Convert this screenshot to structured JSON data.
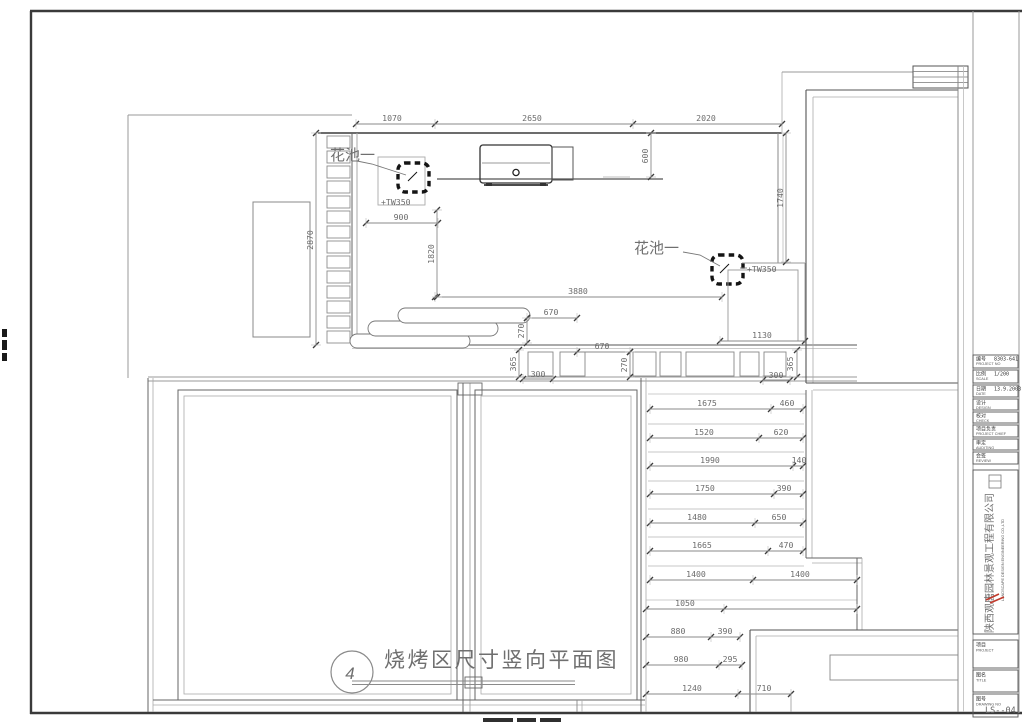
{
  "sheet": {
    "drawing_title": "烧烤区尺寸竖向平面图",
    "view_number": "4",
    "labels": {
      "flower_bed_1": "花池一",
      "flower_bed_1_level": "+TW350",
      "flower_bed_2": "花池一",
      "flower_bed_2_level": "+TW350"
    },
    "dimensions": [
      {
        "t": "1070",
        "x": 392,
        "y": 121
      },
      {
        "t": "2650",
        "x": 532,
        "y": 121
      },
      {
        "t": "2020",
        "x": 706,
        "y": 121
      },
      {
        "t": "600",
        "x": 648,
        "y": 156,
        "r": -90
      },
      {
        "t": "1740",
        "x": 783,
        "y": 198,
        "r": -90
      },
      {
        "t": "2870",
        "x": 313,
        "y": 240,
        "r": -90
      },
      {
        "t": "900",
        "x": 401,
        "y": 220
      },
      {
        "t": "1820",
        "x": 434,
        "y": 254,
        "r": -90
      },
      {
        "t": "3880",
        "x": 578,
        "y": 294
      },
      {
        "t": "670",
        "x": 551,
        "y": 315
      },
      {
        "t": "270",
        "x": 524,
        "y": 331,
        "r": -90
      },
      {
        "t": "1130",
        "x": 762,
        "y": 338
      },
      {
        "t": "365",
        "x": 516,
        "y": 364,
        "r": -90
      },
      {
        "t": "300",
        "x": 538,
        "y": 377
      },
      {
        "t": "670",
        "x": 602,
        "y": 349
      },
      {
        "t": "270",
        "x": 627,
        "y": 365,
        "r": -90
      },
      {
        "t": "365",
        "x": 793,
        "y": 364,
        "r": -90
      },
      {
        "t": "300",
        "x": 776,
        "y": 378
      },
      {
        "t": "1675",
        "x": 707,
        "y": 406
      },
      {
        "t": "460",
        "x": 787,
        "y": 406
      },
      {
        "t": "1520",
        "x": 704,
        "y": 435
      },
      {
        "t": "620",
        "x": 781,
        "y": 435
      },
      {
        "t": "1990",
        "x": 710,
        "y": 463
      },
      {
        "t": "140",
        "x": 799,
        "y": 463
      },
      {
        "t": "1750",
        "x": 705,
        "y": 491
      },
      {
        "t": "390",
        "x": 784,
        "y": 491
      },
      {
        "t": "1480",
        "x": 697,
        "y": 520
      },
      {
        "t": "650",
        "x": 779,
        "y": 520
      },
      {
        "t": "1665",
        "x": 702,
        "y": 548
      },
      {
        "t": "470",
        "x": 786,
        "y": 548
      },
      {
        "t": "1400",
        "x": 696,
        "y": 577
      },
      {
        "t": "1400",
        "x": 800,
        "y": 577
      },
      {
        "t": "1050",
        "x": 685,
        "y": 606
      },
      {
        "t": "880",
        "x": 678,
        "y": 634
      },
      {
        "t": "390",
        "x": 725,
        "y": 634
      },
      {
        "t": "980",
        "x": 681,
        "y": 662
      },
      {
        "t": "295",
        "x": 730,
        "y": 662
      },
      {
        "t": "1240",
        "x": 692,
        "y": 691
      },
      {
        "t": "710",
        "x": 764,
        "y": 691
      }
    ],
    "dim_lines": [
      {
        "o": "h",
        "y": 124,
        "x1": 356,
        "x2": 782,
        "ticks": [
          356,
          435,
          633,
          782
        ]
      },
      {
        "o": "h",
        "y": 223,
        "x1": 366,
        "x2": 438,
        "ticks": [
          366,
          438
        ]
      },
      {
        "o": "h",
        "y": 297,
        "x1": 435,
        "x2": 722,
        "ticks": [
          435,
          722
        ]
      },
      {
        "o": "h",
        "y": 318,
        "x1": 527,
        "x2": 577,
        "ticks": [
          527,
          577
        ]
      },
      {
        "o": "h",
        "y": 341,
        "x1": 720,
        "x2": 805,
        "ticks": [
          720,
          805
        ]
      },
      {
        "o": "h",
        "y": 352,
        "x1": 577,
        "x2": 630,
        "ticks": [
          577,
          630
        ]
      },
      {
        "o": "h",
        "y": 379,
        "x1": 523,
        "x2": 553,
        "ticks": [
          523,
          553
        ]
      },
      {
        "o": "h",
        "y": 380,
        "x1": 763,
        "x2": 790,
        "ticks": [
          763,
          790
        ]
      },
      {
        "o": "h",
        "y": 409,
        "x1": 650,
        "x2": 803,
        "ticks": [
          650,
          771,
          803
        ]
      },
      {
        "o": "h",
        "y": 438,
        "x1": 650,
        "x2": 803,
        "ticks": [
          650,
          759,
          803
        ]
      },
      {
        "o": "h",
        "y": 466,
        "x1": 650,
        "x2": 803,
        "ticks": [
          650,
          793,
          803
        ]
      },
      {
        "o": "h",
        "y": 494,
        "x1": 650,
        "x2": 803,
        "ticks": [
          650,
          774,
          803
        ]
      },
      {
        "o": "h",
        "y": 523,
        "x1": 650,
        "x2": 803,
        "ticks": [
          650,
          755,
          803
        ]
      },
      {
        "o": "h",
        "y": 551,
        "x1": 650,
        "x2": 803,
        "ticks": [
          650,
          768,
          803
        ]
      },
      {
        "o": "h",
        "y": 580,
        "x1": 650,
        "x2": 857,
        "ticks": [
          650,
          753,
          857
        ]
      },
      {
        "o": "h",
        "y": 609,
        "x1": 646,
        "x2": 857,
        "ticks": [
          646,
          724,
          857
        ]
      },
      {
        "o": "h",
        "y": 637,
        "x1": 646,
        "x2": 740,
        "ticks": [
          646,
          711,
          740
        ]
      },
      {
        "o": "h",
        "y": 665,
        "x1": 646,
        "x2": 742,
        "ticks": [
          646,
          719,
          742
        ]
      },
      {
        "o": "h",
        "y": 694,
        "x1": 646,
        "x2": 791,
        "ticks": [
          646,
          738,
          791
        ]
      },
      {
        "o": "v",
        "x": 651,
        "y1": 133,
        "y2": 177,
        "ticks": [
          133,
          177
        ]
      },
      {
        "o": "v",
        "x": 786,
        "y1": 133,
        "y2": 262,
        "ticks": [
          133,
          262
        ]
      },
      {
        "o": "v",
        "x": 316,
        "y1": 133,
        "y2": 345,
        "ticks": [
          133,
          345
        ]
      },
      {
        "o": "v",
        "x": 437,
        "y1": 210,
        "y2": 297,
        "ticks": [
          210,
          297
        ]
      },
      {
        "o": "v",
        "x": 527,
        "y1": 318,
        "y2": 343,
        "ticks": [
          318,
          343
        ]
      },
      {
        "o": "v",
        "x": 519,
        "y1": 350,
        "y2": 377,
        "ticks": [
          350,
          377
        ]
      },
      {
        "o": "v",
        "x": 630,
        "y1": 352,
        "y2": 377,
        "ticks": [
          352,
          377
        ]
      },
      {
        "o": "v",
        "x": 797,
        "y1": 350,
        "y2": 377,
        "ticks": [
          350,
          377
        ]
      }
    ],
    "colors": {
      "dim_text": "#6b6b6b",
      "dim_line": "#8a8a8a",
      "wall_dark": "#3a3a3a",
      "stamp_red": "#c0392b"
    }
  },
  "title_block": {
    "fields": [
      {
        "zh": "编号",
        "en": "PROJECT NO",
        "value": "8303-641"
      },
      {
        "zh": "比例",
        "en": "SCALE",
        "value": "1/200"
      },
      {
        "zh": "日期",
        "en": "DATE",
        "value": "13.9.2003"
      },
      {
        "zh": "设计",
        "en": "DESIGN",
        "value": ""
      },
      {
        "zh": "校对",
        "en": "CHECK",
        "value": ""
      },
      {
        "zh": "项目负责",
        "en": "PROJECT CHIEF",
        "value": ""
      },
      {
        "zh": "审定",
        "en": "AUDITING",
        "value": ""
      },
      {
        "zh": "会签",
        "en": "REVIEW",
        "value": ""
      }
    ],
    "company_cn": "陕西观唐园林景观工程有限公司",
    "company_en": "LANDSCAPE DESIGN ENGINEERING CO.,LTD",
    "sections": {
      "project_zh": "项目",
      "project_en": "PROJECT",
      "title_zh": "图名",
      "title_en": "TITLE",
      "dwg_zh": "图号",
      "dwg_en": "DRAWING NO",
      "dwg_no": "LS--04"
    }
  }
}
